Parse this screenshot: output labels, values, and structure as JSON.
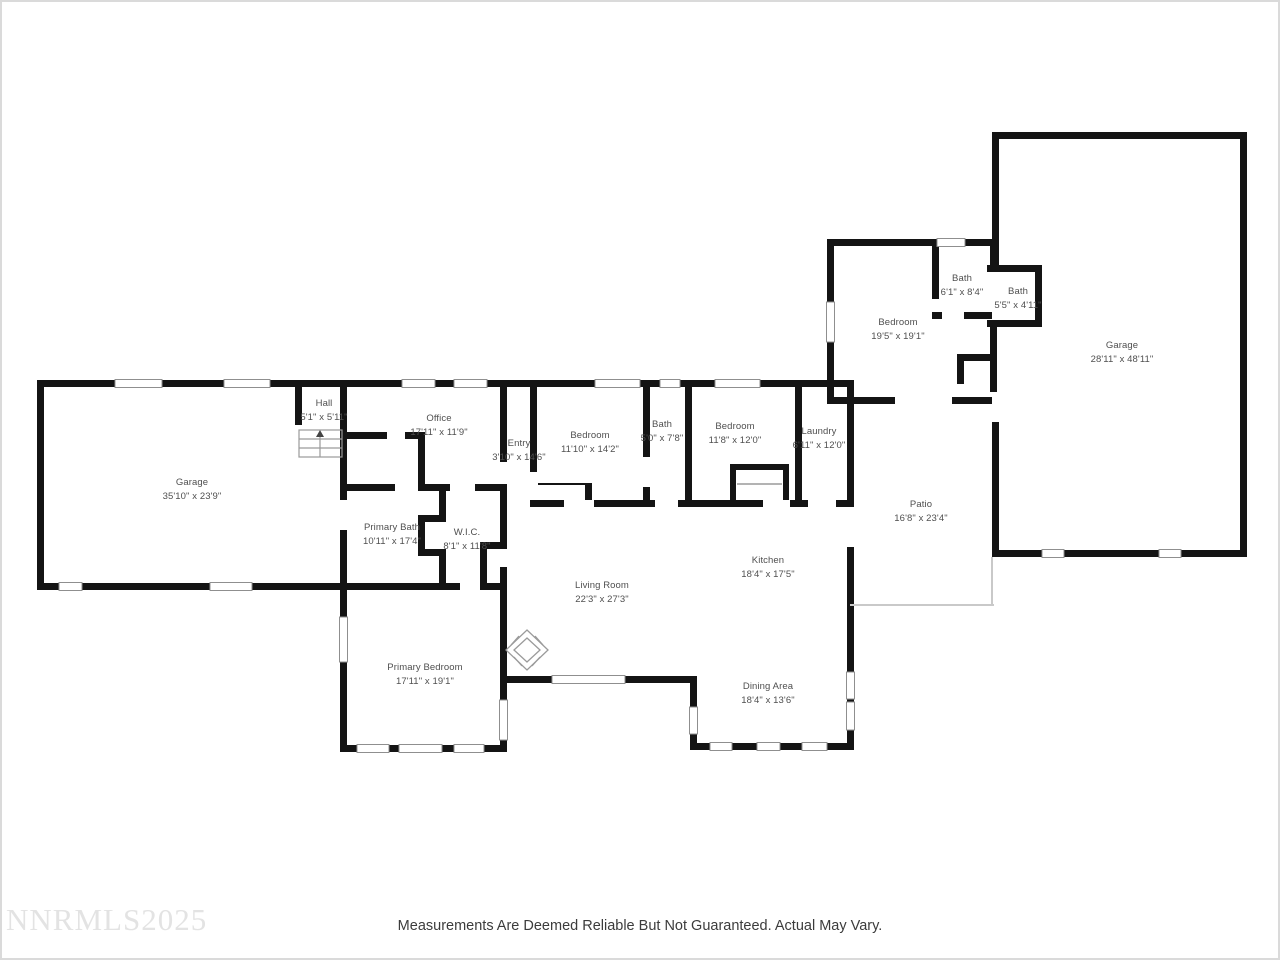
{
  "watermark": "NNRMLS2025",
  "footer": {
    "disclaimer": "Measurements Are Deemed Reliable But Not Guaranteed. Actual May Vary."
  },
  "rooms": [
    {
      "name": "Garage",
      "dims": "35'10\" x 23'9\""
    },
    {
      "name": "Hall",
      "dims": "5'1\" x 5'11\""
    },
    {
      "name": "Office",
      "dims": "17'11\" x 11'9\""
    },
    {
      "name": "Entry",
      "dims": "3'10\" x 14'6\""
    },
    {
      "name": "Bedroom",
      "dims": "11'10\" x 14'2\""
    },
    {
      "name": "Bath",
      "dims": "5'0\" x 7'8\""
    },
    {
      "name": "Bedroom",
      "dims": "11'8\" x 12'0\""
    },
    {
      "name": "Laundry",
      "dims": "6'11\" x 12'0\""
    },
    {
      "name": "Bedroom",
      "dims": "19'5\" x 19'1\""
    },
    {
      "name": "Bath",
      "dims": "6'1\" x 8'4\""
    },
    {
      "name": "Bath",
      "dims": "5'5\" x 4'11\""
    },
    {
      "name": "Garage",
      "dims": "28'11\" x 48'11\""
    },
    {
      "name": "Patio",
      "dims": "16'8\" x 23'4\""
    },
    {
      "name": "Primary Bath",
      "dims": "10'11\" x 17'4\""
    },
    {
      "name": "W.I.C.",
      "dims": "8'1\" x 11'8\""
    },
    {
      "name": "Living Room",
      "dims": "22'3\" x 27'3\""
    },
    {
      "name": "Kitchen",
      "dims": "18'4\" x 17'5\""
    },
    {
      "name": "Primary Bedroom",
      "dims": "17'11\" x 19'1\""
    },
    {
      "name": "Dining Area",
      "dims": "18'4\" x 13'6\""
    }
  ],
  "colors": {
    "wall": "#141414",
    "window_line": "#8f8f8f",
    "patio_outline": "#c9c9c9",
    "label_text": "#4f4f4f",
    "watermark_text": "#e3e3e3"
  }
}
